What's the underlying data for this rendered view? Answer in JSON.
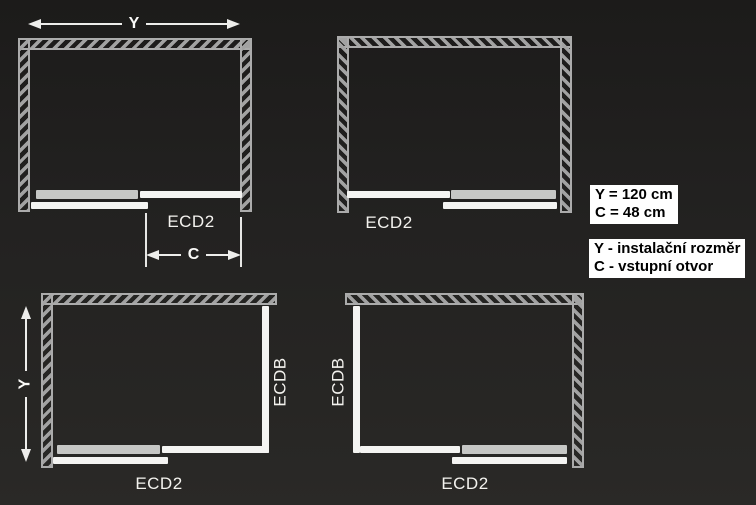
{
  "colors": {
    "background": "#232221",
    "wall_outline": "#ababab",
    "panel_white": "#f4f4f2",
    "panel_gray": "#c6c7c5",
    "label_text": "#f3f2ee",
    "info_box_bg": "#ffffff",
    "info_box_text": "#000000"
  },
  "top_left_diagram": {
    "model": "ECD2",
    "dim_width": "Y",
    "dim_opening": "C"
  },
  "top_right_diagram": {
    "model": "ECD2"
  },
  "bottom_left_diagram": {
    "model": "ECD2",
    "side_panel_model": "ECDB",
    "dim_width": "Y"
  },
  "bottom_right_diagram": {
    "model": "ECD2",
    "side_panel_model": "ECDB"
  },
  "spec_box": {
    "line1": "Y = 120 cm",
    "line2": "C = 48 cm"
  },
  "legend_box": {
    "line1": "Y - instalační rozměr",
    "line2": "C - vstupní otvor"
  }
}
